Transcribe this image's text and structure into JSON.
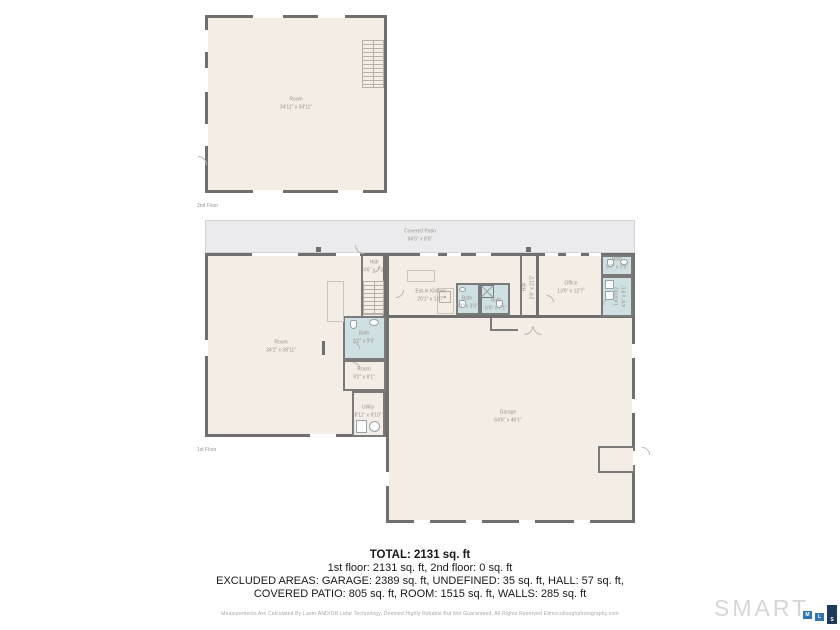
{
  "meta": {
    "doc_type": "floor-plan-sheet"
  },
  "colors": {
    "wall": "#6f6f6f",
    "floor_fill": "#f3ede6",
    "wet_room_fill": "#cfe0e3",
    "patio_fill": "#ebebee",
    "label_text": "#9b948c",
    "summary_text": "#181818",
    "logo_gray": "#d6d6d6",
    "logo_blue": "#2f76b4",
    "logo_navy": "#1d3a5a"
  },
  "floors": {
    "second": {
      "caption": "2nd Floor"
    },
    "first": {
      "caption": "1st Floor"
    }
  },
  "rooms": {
    "room2": {
      "name": "Room",
      "dims": "34'11\" x 34'11\""
    },
    "patio": {
      "name": "Covered Patio",
      "dims": "94'5\" x 8'5\""
    },
    "room1": {
      "name": "Room",
      "dims": "34'1\" x 38'11\""
    },
    "hall": {
      "name": "Hall",
      "dims": "4'6\" x 7'3\""
    },
    "kitchen": {
      "name": "Eat-in Kitchen",
      "dims": "20'1\" x 12'7\""
    },
    "bath_mid": {
      "name": "Bath",
      "dims": "9'2\" x 9'8\""
    },
    "room_small": {
      "name": "Room",
      "dims": "9'2\" x 8'1\""
    },
    "utility": {
      "name": "Utility",
      "dims": "8'11\" x 9'10\""
    },
    "bath_a": {
      "name": "Bath",
      "dims": "8'1\" x 3'6\""
    },
    "bath_b": {
      "name": "Bath",
      "dims": "6'6\" x 7'1\""
    },
    "hall_v": {
      "name": "Hall",
      "dims": "2'8\" x 21'2\""
    },
    "office": {
      "name": "Office",
      "dims": "13'9\" x 12'7\""
    },
    "bath_c": {
      "name": "Bath",
      "dims": "6'7\" x 3'9\""
    },
    "laundry": {
      "name": "Laundry",
      "dims": "4'6\" x 9'1\""
    },
    "garage": {
      "name": "Garage",
      "dims": "54'6\" x 46'1\""
    }
  },
  "summary": {
    "total": "TOTAL: 2131 sq. ft",
    "line2": "1st floor: 2131 sq. ft, 2nd floor: 0 sq. ft",
    "line3": "EXCLUDED AREAS: GARAGE: 2389 sq. ft, UNDEFINED: 35 sq. ft, HALL: 57 sq. ft,",
    "line4": "COVERED PATIO: 805 sq. ft, ROOM: 1515 sq. ft, WALLS: 285 sq. ft"
  },
  "footer": {
    "disclaimer": "Measurements Are Calculated By Laser AND/OR Lidar Technology, Deemed Highly Reliable But Not Guaranteed. All Rights Reserved Edmcculloughphotography.com",
    "logo": {
      "word": "SMART",
      "boxes": [
        "M",
        "L",
        "S"
      ]
    }
  }
}
